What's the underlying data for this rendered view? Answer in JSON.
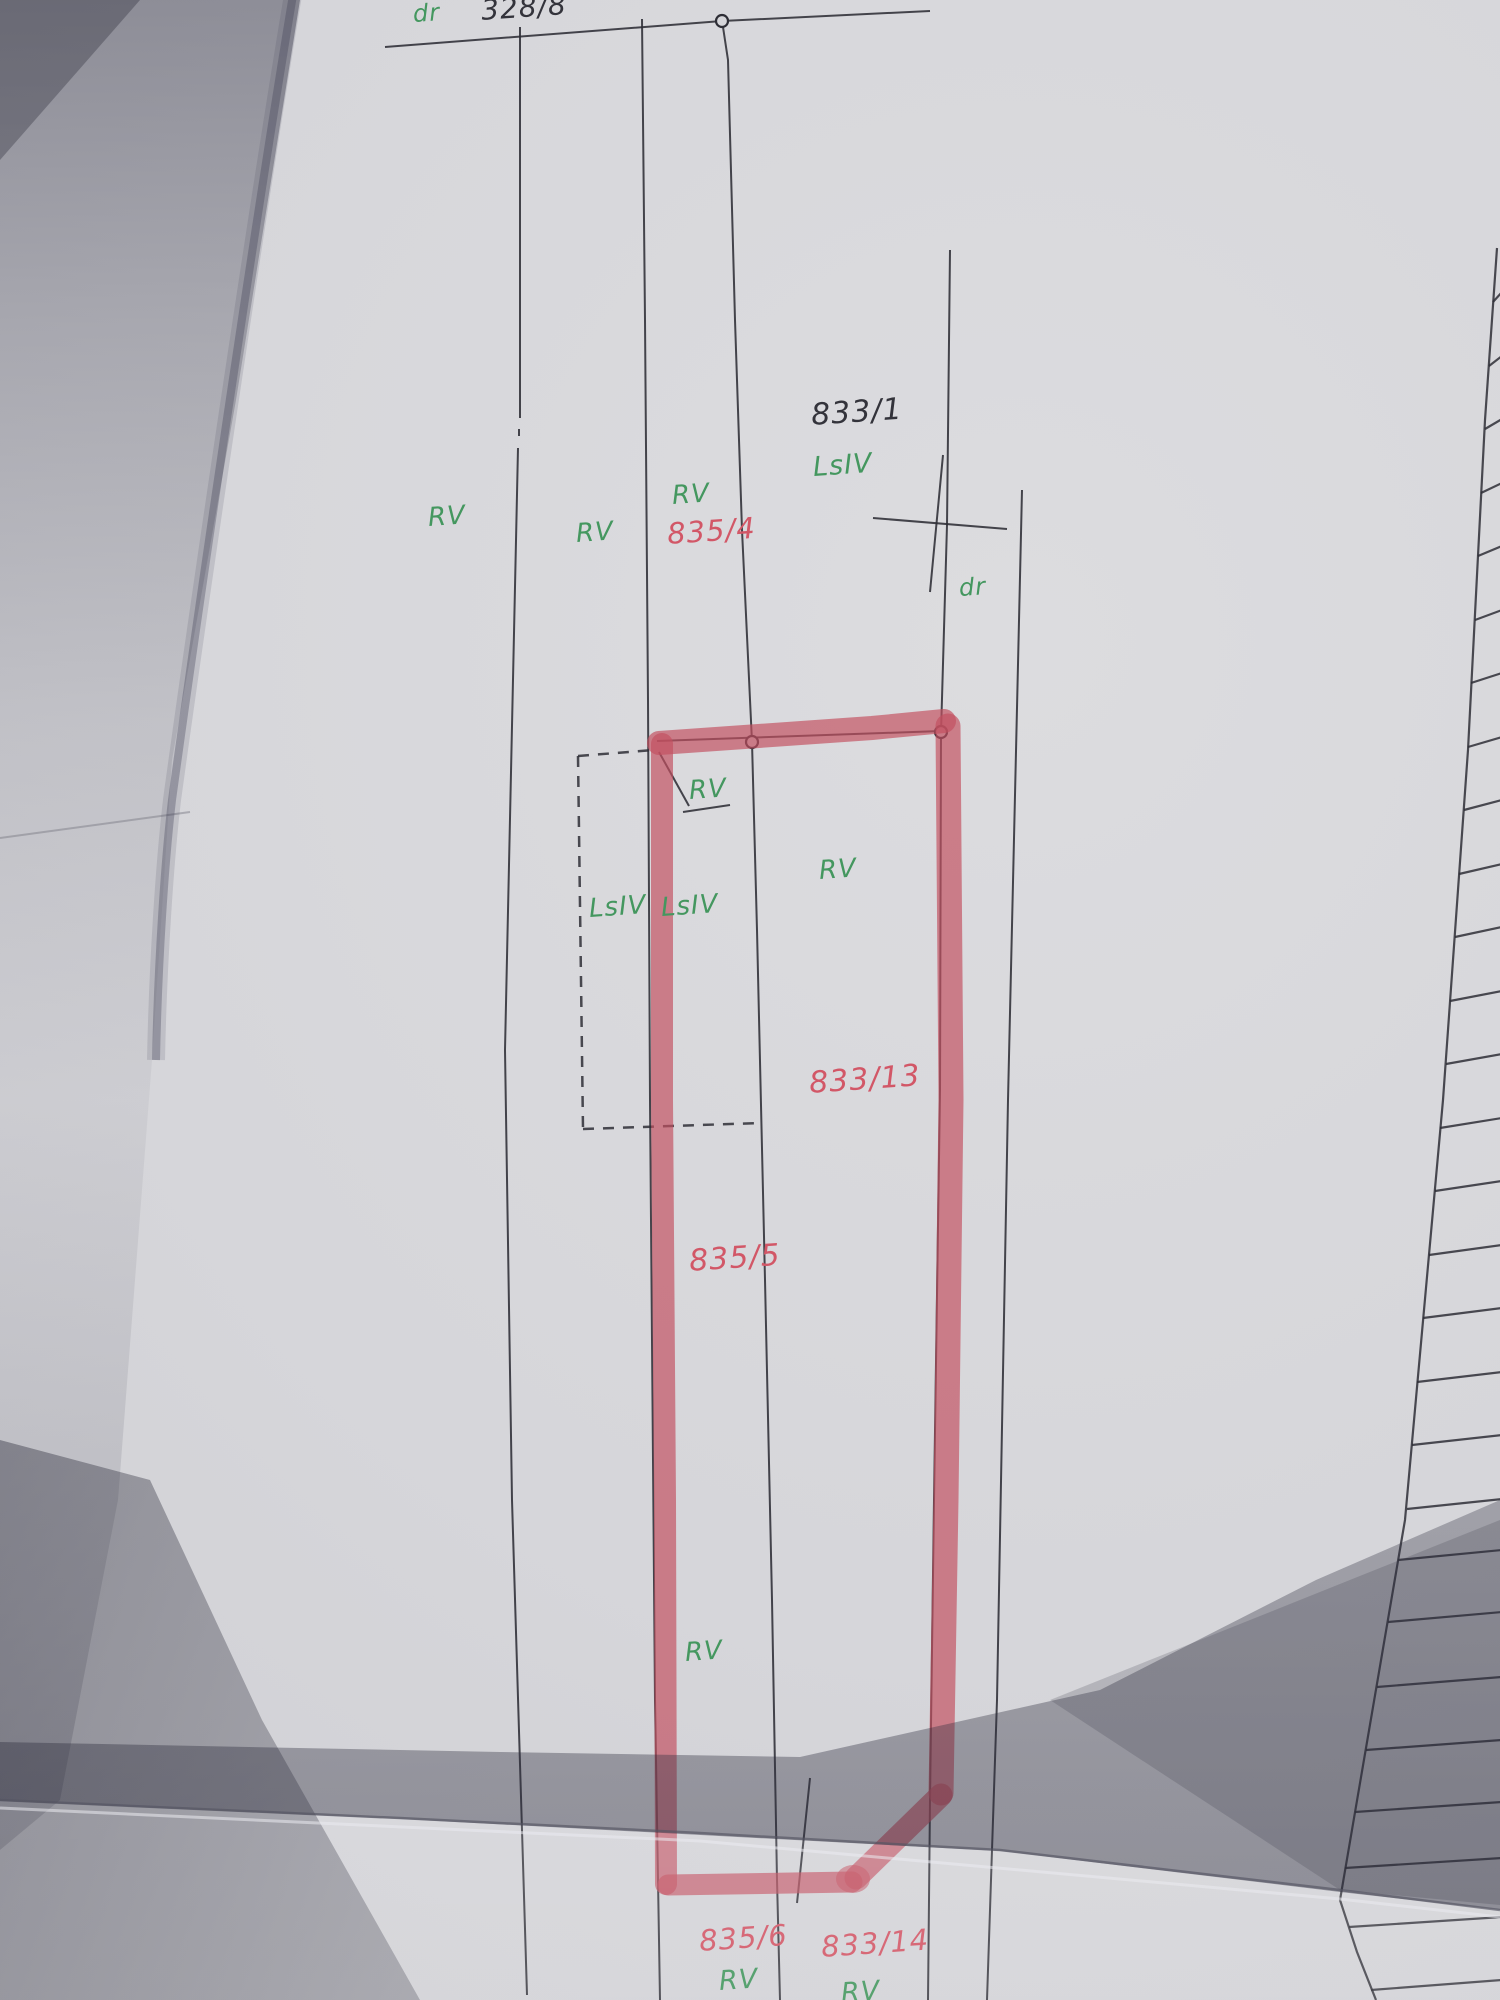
{
  "document_kind": "cadastral parcel map (paper photograph)",
  "colors": {
    "paper": "#d6d6da",
    "ink": "#33333b",
    "landuse_green": "#44975f",
    "parcel_red": "#d25767",
    "marker_red": "#c25060"
  },
  "symbols": {
    "survey_point": "open-circle",
    "boundary_tick": "slanted-line",
    "unsurveyed_boundary": "dashed-line",
    "highlight": "red-marker-outline",
    "right_edge": "adjacent-sheet-ladder-grid"
  },
  "map": {
    "labels": [
      {
        "id": "road-top",
        "text": "dr",
        "kind": "road",
        "color": "green"
      },
      {
        "id": "parcel-328-8",
        "text": "328/8",
        "kind": "parcel",
        "color": "ink"
      },
      {
        "id": "parcel-833-1",
        "text": "833/1",
        "kind": "parcel",
        "color": "ink"
      },
      {
        "id": "landuse-833-1",
        "text": "LsIV",
        "kind": "landuse",
        "color": "green"
      },
      {
        "id": "landuse-rv-left",
        "text": "RV",
        "kind": "landuse",
        "color": "green"
      },
      {
        "id": "landuse-rv-mid",
        "text": "RV",
        "kind": "landuse",
        "color": "green"
      },
      {
        "id": "landuse-rv-835-4",
        "text": "RV",
        "kind": "landuse",
        "color": "green"
      },
      {
        "id": "parcel-835-4",
        "text": "835/4",
        "kind": "parcel",
        "color": "red"
      },
      {
        "id": "road-right",
        "text": "dr",
        "kind": "road",
        "color": "green"
      },
      {
        "id": "landuse-rv-pointer",
        "text": "RV",
        "kind": "landuse",
        "color": "green"
      },
      {
        "id": "landuse-rv-833-13",
        "text": "RV",
        "kind": "landuse",
        "color": "green"
      },
      {
        "id": "landuse-lsiv-left",
        "text": "LsIV",
        "kind": "landuse",
        "color": "green"
      },
      {
        "id": "landuse-lsiv-right",
        "text": "LsIV",
        "kind": "landuse",
        "color": "green"
      },
      {
        "id": "parcel-833-13",
        "text": "833/13",
        "kind": "parcel",
        "color": "red"
      },
      {
        "id": "parcel-835-5",
        "text": "835/5",
        "kind": "parcel",
        "color": "red"
      },
      {
        "id": "landuse-rv-835-5",
        "text": "RV",
        "kind": "landuse",
        "color": "green"
      },
      {
        "id": "parcel-835-6",
        "text": "835/6",
        "kind": "parcel",
        "color": "red"
      },
      {
        "id": "landuse-rv-835-6",
        "text": "RV",
        "kind": "landuse",
        "color": "green"
      },
      {
        "id": "parcel-833-14",
        "text": "833/14",
        "kind": "parcel",
        "color": "red"
      },
      {
        "id": "landuse-rv-833-14",
        "text": "RV",
        "kind": "landuse",
        "color": "green"
      }
    ]
  }
}
